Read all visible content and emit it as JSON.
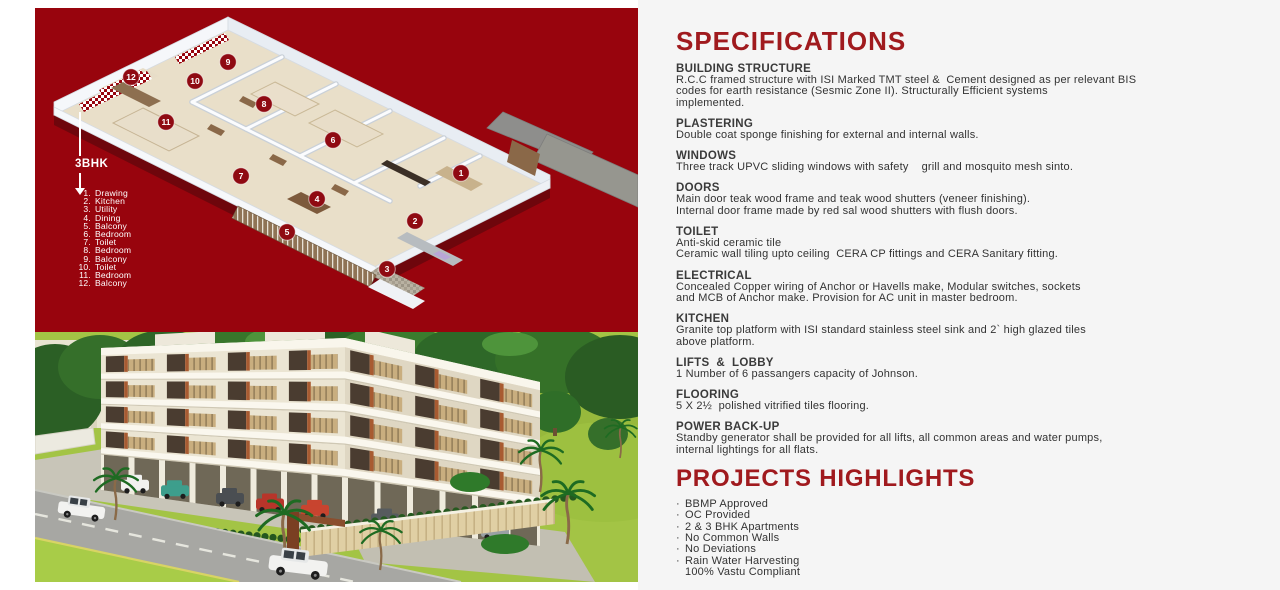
{
  "colors": {
    "panel_red": "#98040D",
    "title_red": "#A01A1E",
    "marker_red": "#8F0A12",
    "body_text": "#333333",
    "page_bg_right": "#F5F5F5"
  },
  "floorplan": {
    "type_label": "3BHK",
    "legend": [
      {
        "num": "1.",
        "name": "Drawing"
      },
      {
        "num": "2.",
        "name": "Kitchen"
      },
      {
        "num": "3.",
        "name": "Utility"
      },
      {
        "num": "4.",
        "name": "Dining"
      },
      {
        "num": "5.",
        "name": "Balcony"
      },
      {
        "num": "6.",
        "name": "Bedroom"
      },
      {
        "num": "7.",
        "name": "Toilet"
      },
      {
        "num": "8.",
        "name": "Bedroom"
      },
      {
        "num": "9.",
        "name": "Balcony"
      },
      {
        "num": "10.",
        "name": "Toilet"
      },
      {
        "num": "11.",
        "name": "Bedroom"
      },
      {
        "num": "12.",
        "name": "Balcony"
      }
    ],
    "markers": [
      {
        "n": "1",
        "x": 426,
        "y": 165
      },
      {
        "n": "2",
        "x": 380,
        "y": 213
      },
      {
        "n": "3",
        "x": 352,
        "y": 261
      },
      {
        "n": "4",
        "x": 282,
        "y": 191
      },
      {
        "n": "5",
        "x": 252,
        "y": 224
      },
      {
        "n": "6",
        "x": 298,
        "y": 132
      },
      {
        "n": "7",
        "x": 206,
        "y": 168
      },
      {
        "n": "8",
        "x": 229,
        "y": 96
      },
      {
        "n": "9",
        "x": 193,
        "y": 54
      },
      {
        "n": "10",
        "x": 160,
        "y": 73
      },
      {
        "n": "11",
        "x": 131,
        "y": 114
      },
      {
        "n": "12",
        "x": 96,
        "y": 69
      }
    ]
  },
  "specifications": {
    "title": "SPECIFICATIONS",
    "sections": [
      {
        "heading": "BUILDING STRUCTURE",
        "lines": [
          "R.C.C framed structure with ISI Marked TMT steel &  Cement designed as per relevant BIS",
          "codes for earth resistance (Sesmic Zone II). Structurally Efficient systems",
          "implemented."
        ]
      },
      {
        "heading": "PLASTERING",
        "lines": [
          "Double coat sponge finishing for external and internal walls."
        ]
      },
      {
        "heading": "WINDOWS",
        "lines": [
          "Three track UPVC sliding windows with safety    grill and mosquito mesh sinto."
        ]
      },
      {
        "heading": "DOORS",
        "lines": [
          "Main door teak wood frame and teak wood shutters (veneer finishing).",
          "Internal door frame made by red sal wood shutters with flush doors."
        ]
      },
      {
        "heading": "TOILET",
        "lines": [
          "Anti-skid ceramic tile",
          "Ceramic wall tiling upto ceiling  CERA CP fittings and CERA Sanitary fitting."
        ]
      },
      {
        "heading": "ELECTRICAL",
        "lines": [
          "Concealed Copper wiring of Anchor or Havells make, Modular switches, sockets",
          "and MCB of Anchor make. Provision for AC unit in master bedroom."
        ]
      },
      {
        "heading": "KITCHEN",
        "lines": [
          "Granite top platform with ISI standard stainless steel sink and 2` high glazed tiles",
          "above platform."
        ]
      },
      {
        "heading": "LIFTS  &  LOBBY",
        "lines": [
          "1 Number of 6 passangers capacity of Johnson."
        ]
      },
      {
        "heading": "FLOORING",
        "lines": [
          "5 X 2½  polished vitrified tiles flooring."
        ]
      },
      {
        "heading": "POWER BACK-UP",
        "lines": [
          "Standby generator shall be provided for all lifts, all common areas and water pumps,",
          "internal lightings for all flats."
        ]
      }
    ]
  },
  "highlights": {
    "title": "PROJECTS HIGHLIGHTS",
    "bullet_char": "·",
    "items": [
      "BBMP Approved",
      "OC Provided",
      "2 & 3 BHK Apartments",
      "No Common Walls",
      "No Deviations",
      "Rain Water Harvesting"
    ],
    "sub_item": "100% Vastu Compliant"
  }
}
